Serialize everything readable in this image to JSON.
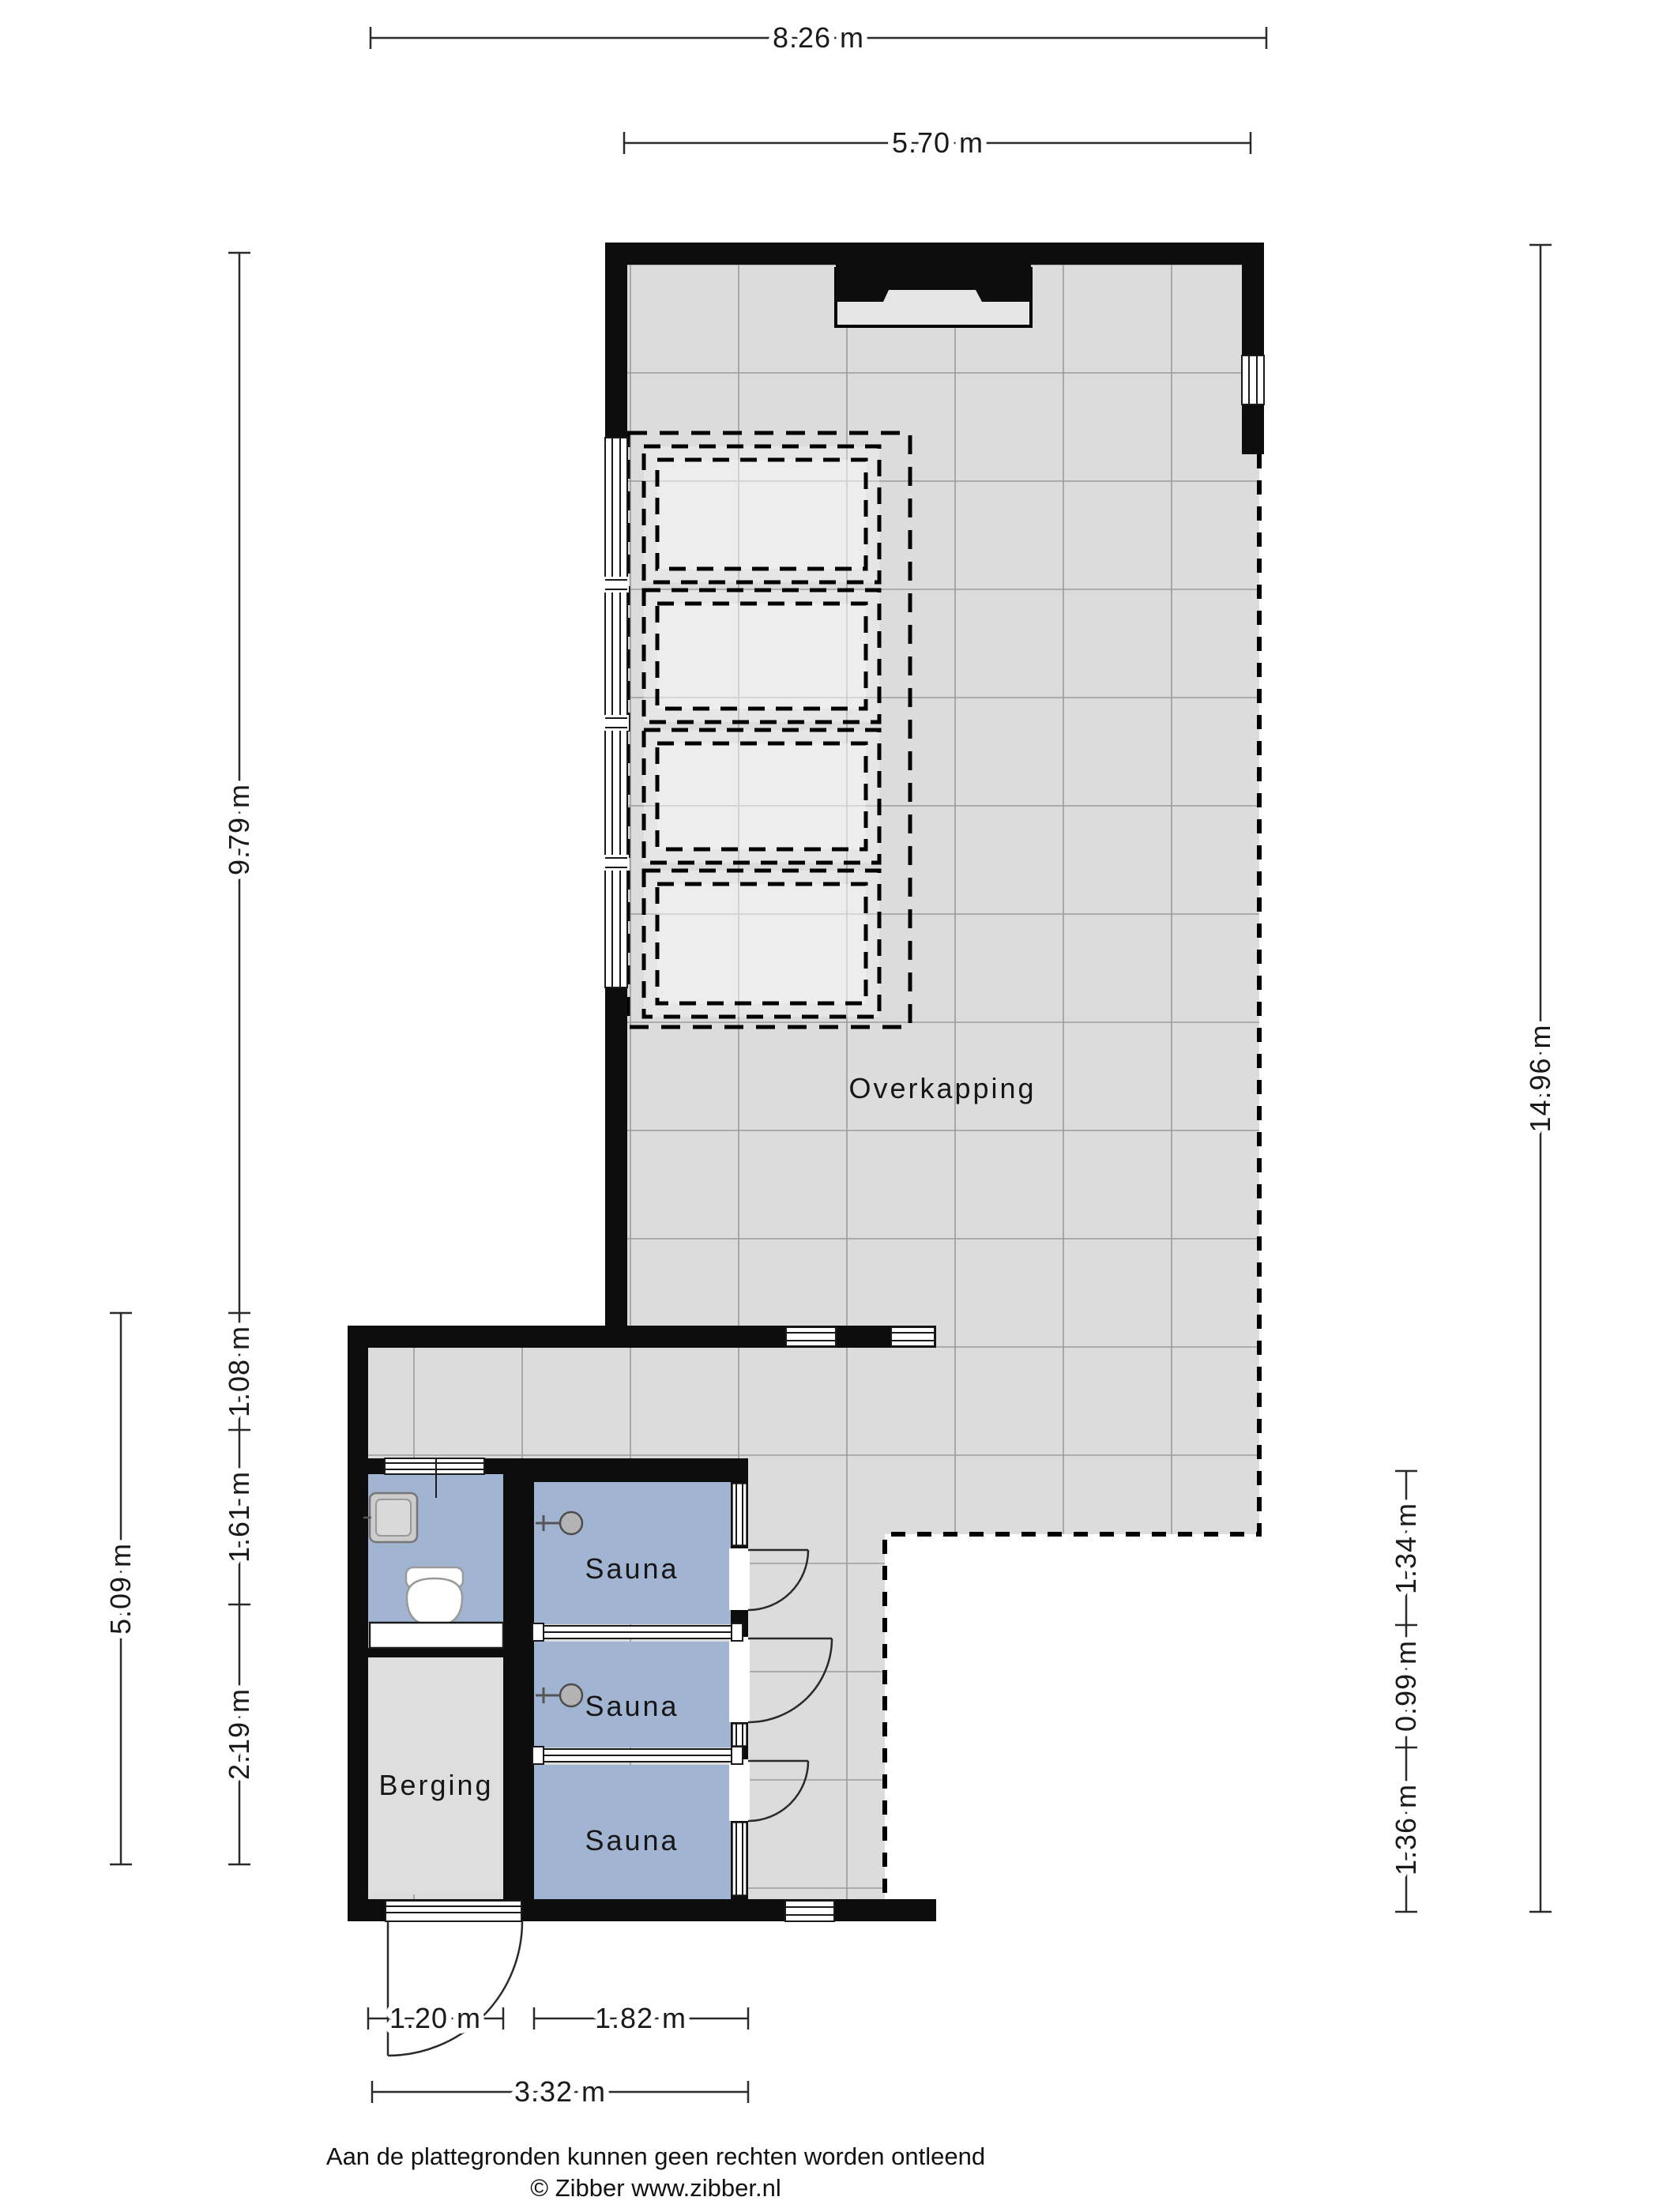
{
  "page": {
    "background": "#ffffff"
  },
  "colors": {
    "wall": "#0d0d0d",
    "floor": "#dcdcdc",
    "floor_recess": "#e6e6e6",
    "grid_line": "#9b9b9b",
    "room_blue": "#a1b4d1",
    "fixture_fill": "#cccccc",
    "dim_line": "#2b2b2b",
    "text": "#1a1a1a"
  },
  "rooms": {
    "overkapping": "Overkapping",
    "sauna_1": "Sauna",
    "sauna_2": "Sauna",
    "sauna_3": "Sauna",
    "berging": "Berging"
  },
  "dimensions": {
    "overall_width": "8.26 m",
    "overkapping_inner_width": "5.70 m",
    "left_upper_height": "9.79 m",
    "right_total_height": "14.96 m",
    "left_annex_total": "5.09 m",
    "annex_corridor": "1.08 m",
    "annex_toilet": "1.61 m",
    "annex_berging": "2.19 m",
    "sauna_top": "1.34 m",
    "sauna_middle": "0.99 m",
    "sauna_bottom": "1.36 m",
    "berging_width": "1.20 m",
    "sauna_width": "1.82 m",
    "annex_total_width": "3.32 m"
  },
  "footer": {
    "disclaimer": "Aan de plattegronden kunnen geen rechten worden ontleend",
    "copyright": "© Zibber www.zibber.nl"
  }
}
